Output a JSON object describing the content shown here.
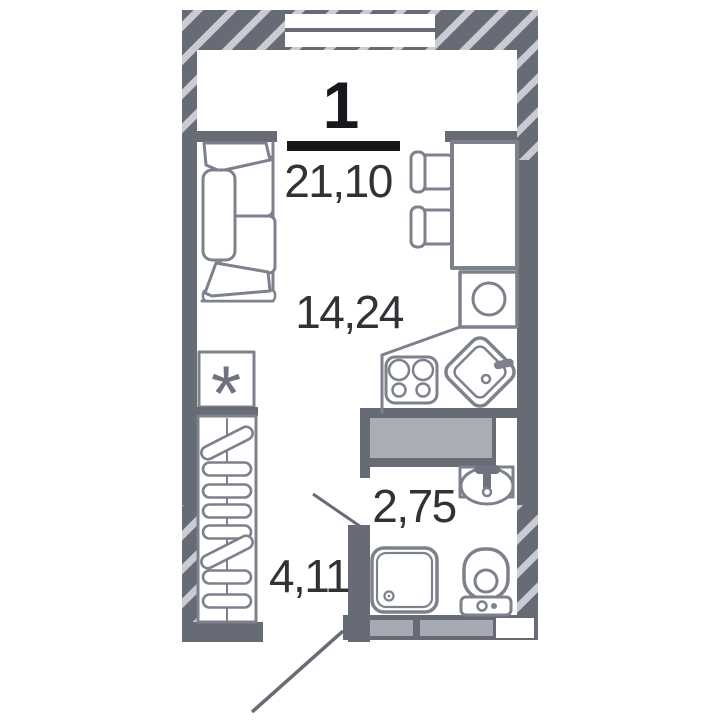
{
  "plan": {
    "rooms_count": "1",
    "total_area": "21,10",
    "rooms": [
      {
        "name": "living-kitchen",
        "area": "14,24"
      },
      {
        "name": "bathroom",
        "area": "2,75"
      },
      {
        "name": "hallway",
        "area": "4,11"
      }
    ],
    "appliance_symbol": "*"
  },
  "colors": {
    "wall": "#676b75",
    "hatch_stripe": "#c9ccd2",
    "furniture_stroke": "#7d818b",
    "duct_fill": "#a9adb4",
    "wall_inset": "#a6aab2",
    "area_text": "#303236",
    "rooms_text": "#17181c",
    "background": "#ffffff"
  },
  "furniture": [
    "sofa",
    "dining-table",
    "chair",
    "chair",
    "washing-machine",
    "stove",
    "kitchen-sink",
    "ventilation-duct",
    "washbasin",
    "shower",
    "toilet",
    "wardrobe-with-hangers",
    "appliance-marker",
    "window"
  ]
}
